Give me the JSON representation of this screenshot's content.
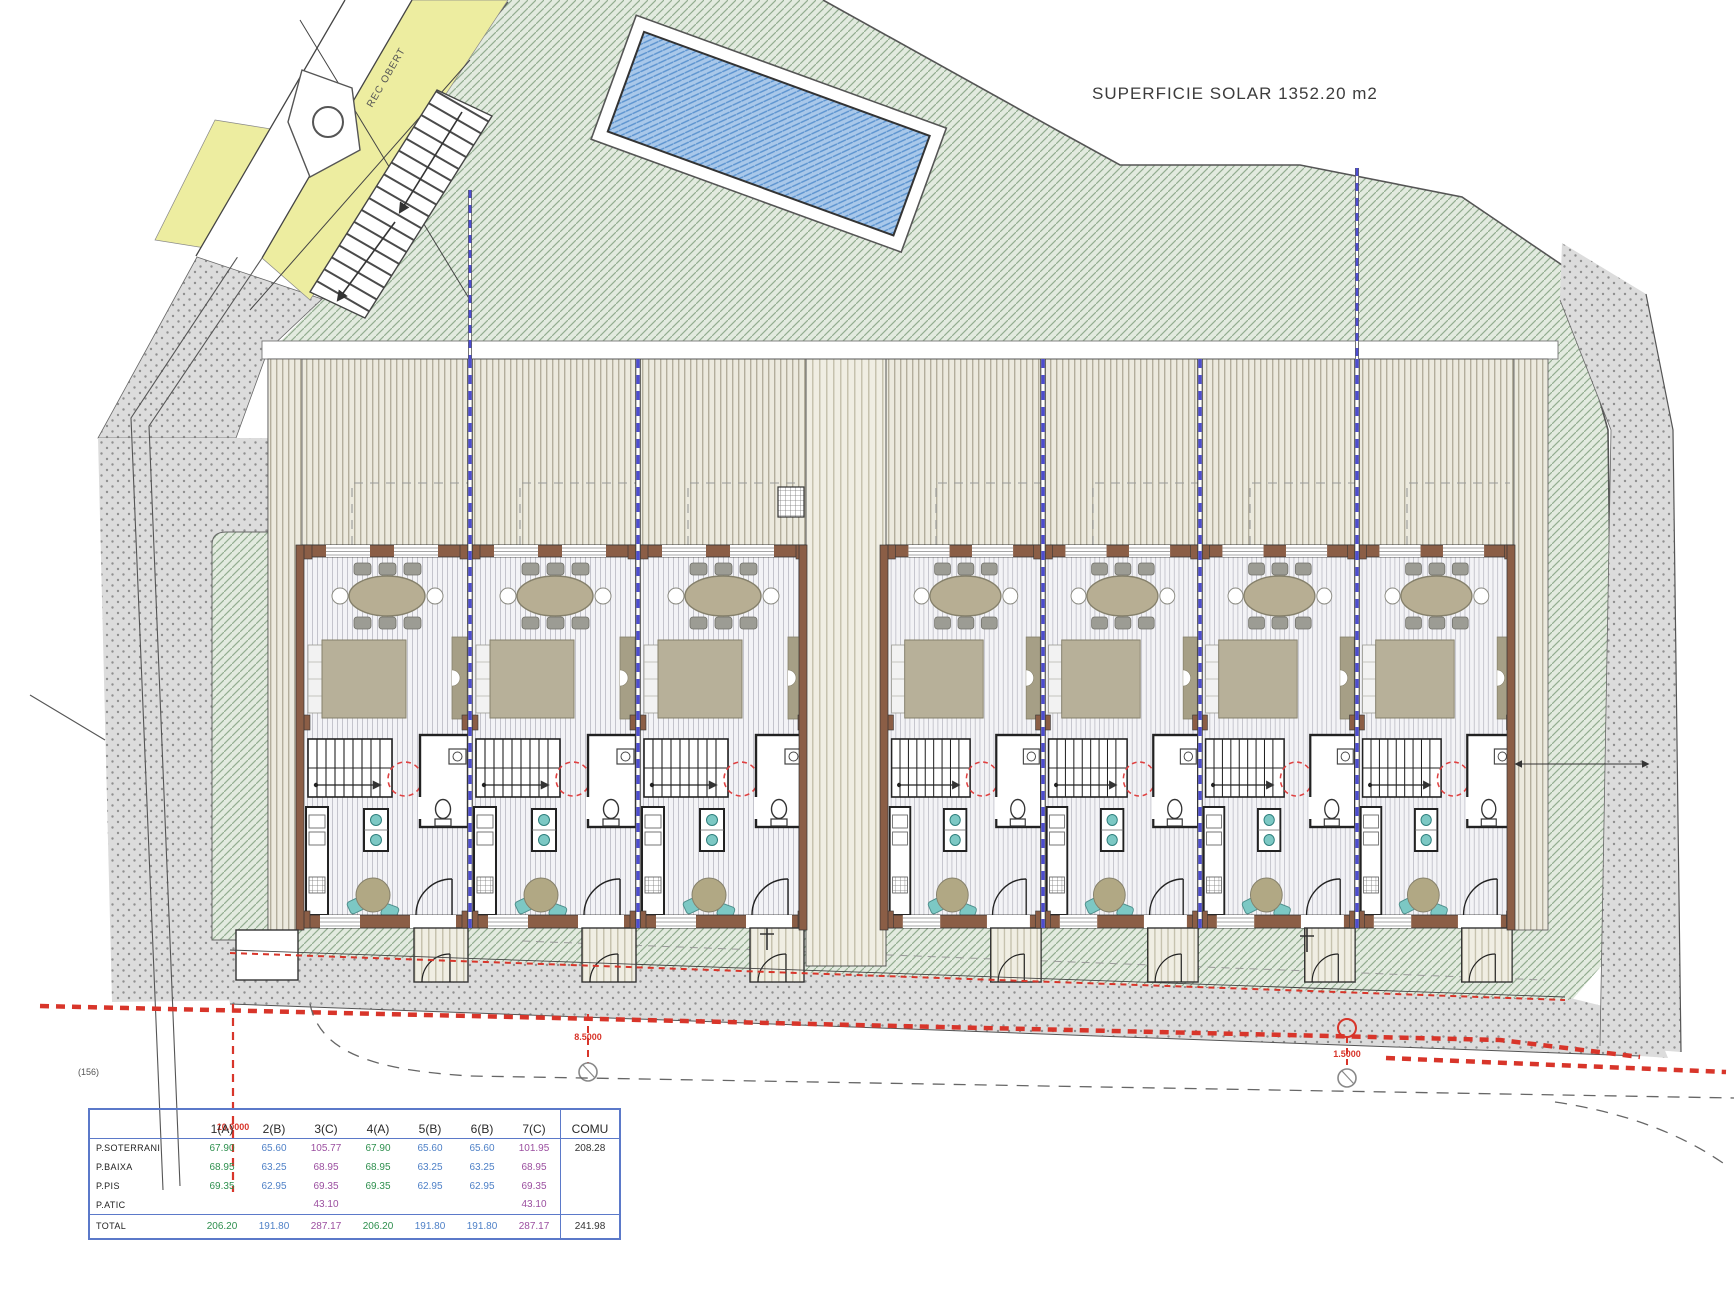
{
  "title": "SUPERFICIE SOLAR  1352.20 m2",
  "labels": {
    "rec_obert": "REC OBERT",
    "ref": "(156)"
  },
  "dimensions": {
    "d1": "10.0000",
    "d2": "8.5000",
    "d3": "1.5000"
  },
  "colors": {
    "accent_red": "#d8352a",
    "party_wall_blue": "#4d4dd0",
    "pool_blue": "#a9c8ea",
    "garden_green": "#e2eadf",
    "road_yellow": "#ededa0",
    "table_border_blue": "#5b79c9",
    "type_a_green": "#2e8f4e",
    "type_b_blue": "#4f81c7",
    "type_c_purple": "#9b4fa0"
  },
  "table": {
    "columns": [
      "",
      "1(A)",
      "2(B)",
      "3(C)",
      "4(A)",
      "5(B)",
      "6(B)",
      "7(C)",
      "COMU"
    ],
    "col_types": [
      "label",
      "A",
      "B",
      "C",
      "A",
      "B",
      "B",
      "C",
      "COMU"
    ],
    "rows": [
      {
        "label": "P.SOTERRANI",
        "values": [
          "67.90",
          "65.60",
          "105.77",
          "67.90",
          "65.60",
          "65.60",
          "101.95",
          "208.28"
        ]
      },
      {
        "label": "P.BAIXA",
        "values": [
          "68.95",
          "63.25",
          "68.95",
          "68.95",
          "63.25",
          "63.25",
          "68.95",
          ""
        ]
      },
      {
        "label": "P.PIS",
        "values": [
          "69.35",
          "62.95",
          "69.35",
          "69.35",
          "62.95",
          "62.95",
          "69.35",
          ""
        ]
      },
      {
        "label": "P.ATIC",
        "values": [
          "",
          "",
          "43.10",
          "",
          "",
          "",
          "43.10",
          ""
        ]
      }
    ],
    "total_row": {
      "label": "TOTAL",
      "values": [
        "206.20",
        "191.80",
        "287.17",
        "206.20",
        "191.80",
        "191.80",
        "287.17",
        "241.98"
      ]
    }
  }
}
